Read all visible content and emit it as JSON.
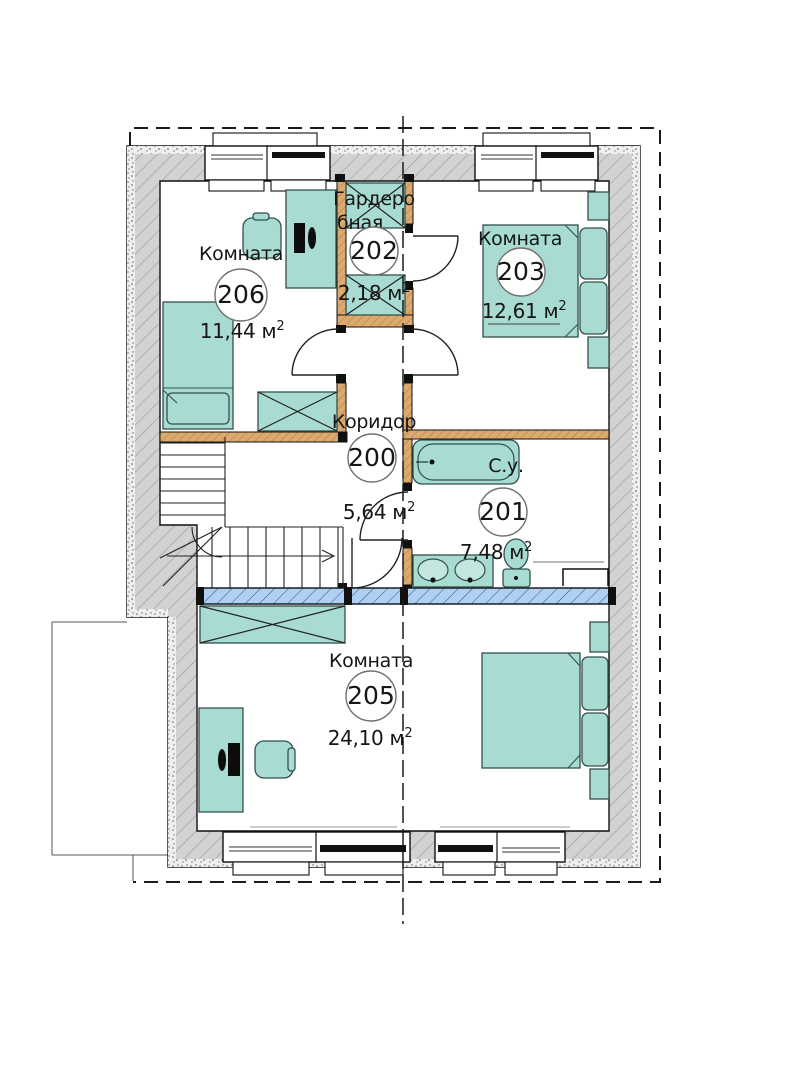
{
  "plan_title": "Floor plan, level 2",
  "rooms": {
    "r206": {
      "name": "Комната",
      "number": "206",
      "area": "11,44 м",
      "area_sup": "2"
    },
    "r202": {
      "name_line1": "Гардеро",
      "name_line2": "бная",
      "number": "202",
      "area": "2,18 м",
      "area_sup": "2"
    },
    "r203": {
      "name": "Комната",
      "number": "203",
      "area": "12,61 м",
      "area_sup": "2"
    },
    "r200": {
      "name": "Коридор",
      "number": "200",
      "area": "5,64 м",
      "area_sup": "2"
    },
    "r201": {
      "name": "С.у.",
      "number": "201",
      "area": "7,48 м",
      "area_sup": "2"
    },
    "r205": {
      "name": "Комната",
      "number": "205",
      "area": "24,10 м",
      "area_sup": "2"
    }
  },
  "colors": {
    "furniture_fill": "#a8dbd2",
    "exterior_wall_fill": "#d2d2d2",
    "interior_wall_fill": "#dcaa6e",
    "glass_partition_fill": "#b0cff2",
    "outline": "#111111"
  }
}
